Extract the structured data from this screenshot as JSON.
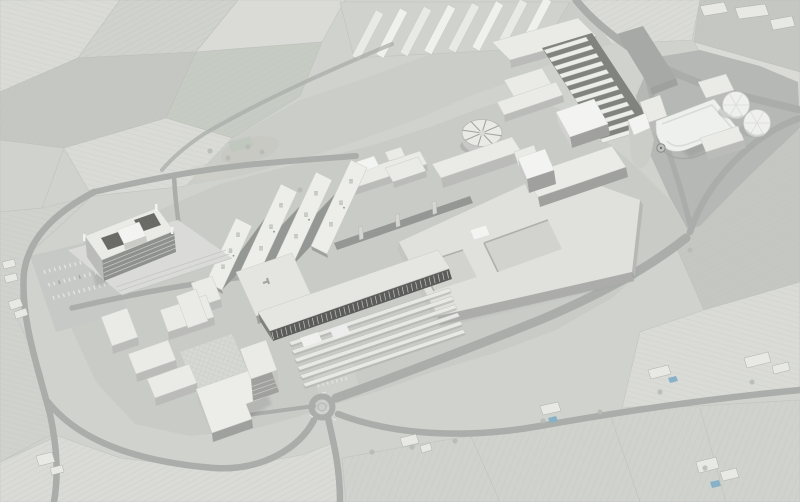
{
  "meta": {
    "description": "Monochrome aerial masterplan rendering: white architectural massing model of a technology-park campus placed over a pale grayscale aerial photograph of vineyards, orchards, country roads and scattered farmsteads",
    "view": "oblique-birds-eye",
    "text_content": "none"
  },
  "palette": {
    "field_base": "#cdd0cb",
    "field_light": "#d8dad5",
    "field_lighter": "#dfe1dc",
    "field_dark": "#c2c5c0",
    "field_green": "#c3cac1",
    "road": "#a6a9a6",
    "apron": "#c7c9c5",
    "yard": "#b3b5b2",
    "plinth": "#d9dad6",
    "roof": "#e9eae6",
    "bright": "#f3f4f1",
    "block": "#dfe0dc",
    "wall": "#b8b9b6",
    "wall_dark": "#9b9c99",
    "wall_deep": "#8a8c89",
    "courtyard": "#90928f",
    "roof_dark": "#a3a5a2",
    "stripe_wall": "#545553",
    "sunken": "#d0d1cd",
    "pool": "#82adc4",
    "line": "#b6b9b4",
    "tick": "#e9eae5",
    "shadow": "#3c3e3a",
    "tree": "#b2b8af"
  },
  "scene": {
    "landmarks": [
      "headquarters-slab-with-roof-courtyards",
      "housing-cluster-with-plaza",
      "four-lab-finger-buildings",
      "striped-facade-hall",
      "greenhouse-research-rows",
      "central-elevated-walkway",
      "round-spoke-roof-pavilion",
      "sawtooth-shed-band",
      "large-courtyard-block",
      "flatiron-wedge-tower",
      "rounded-corner-hall",
      "twin-storage-tanks",
      "roundabout",
      "country-road",
      "western-parking-lot",
      "farmsteads-with-pools"
    ],
    "counts": {
      "lab_fingers": 4,
      "sawtooth_teeth": 12,
      "greenhouse_rows": 6,
      "storage_tanks": 2,
      "housing_blocks": 7,
      "roundabouts": 1,
      "swimming_pools": 3
    }
  }
}
